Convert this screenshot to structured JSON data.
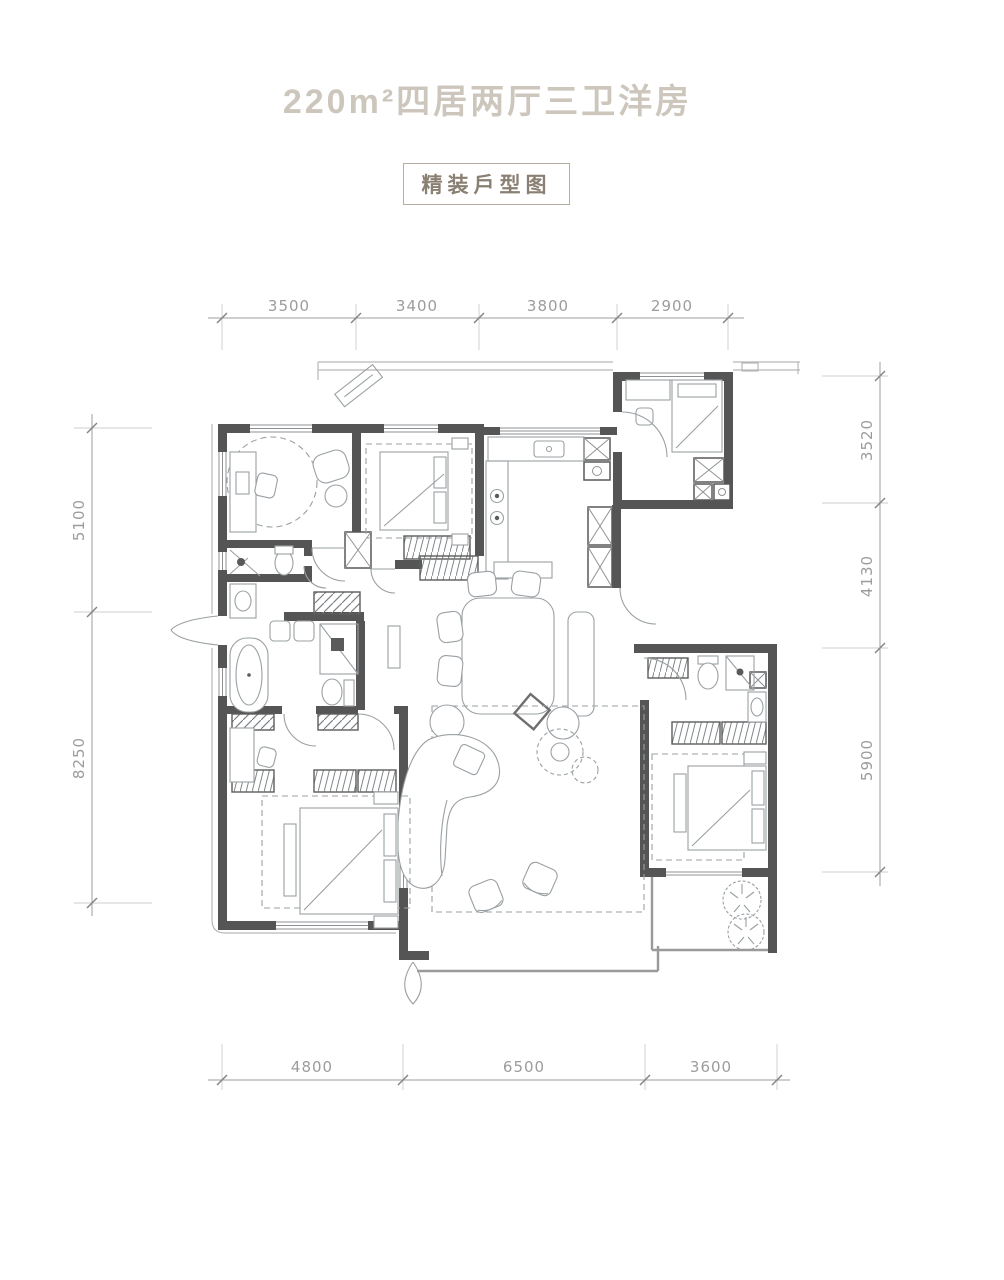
{
  "title": "220m²四居两厅三卫洋房",
  "stamp": {
    "label": "精装戶型图"
  },
  "dimensions": {
    "top": [
      "3500",
      "3400",
      "3800",
      "2900"
    ],
    "right": [
      "3520",
      "4130",
      "5900"
    ],
    "left": [
      "5100",
      "8250"
    ],
    "bottom": [
      "4800",
      "6500",
      "3600"
    ]
  },
  "colors": {
    "wall": "#555555",
    "furniture": "#9aa0a3",
    "dimension": "#9c9c9c",
    "title_text": "#cdc6bc",
    "stamp_text": "#8a7f73",
    "stamp_border": "#b6ada1",
    "background": "#ffffff"
  }
}
